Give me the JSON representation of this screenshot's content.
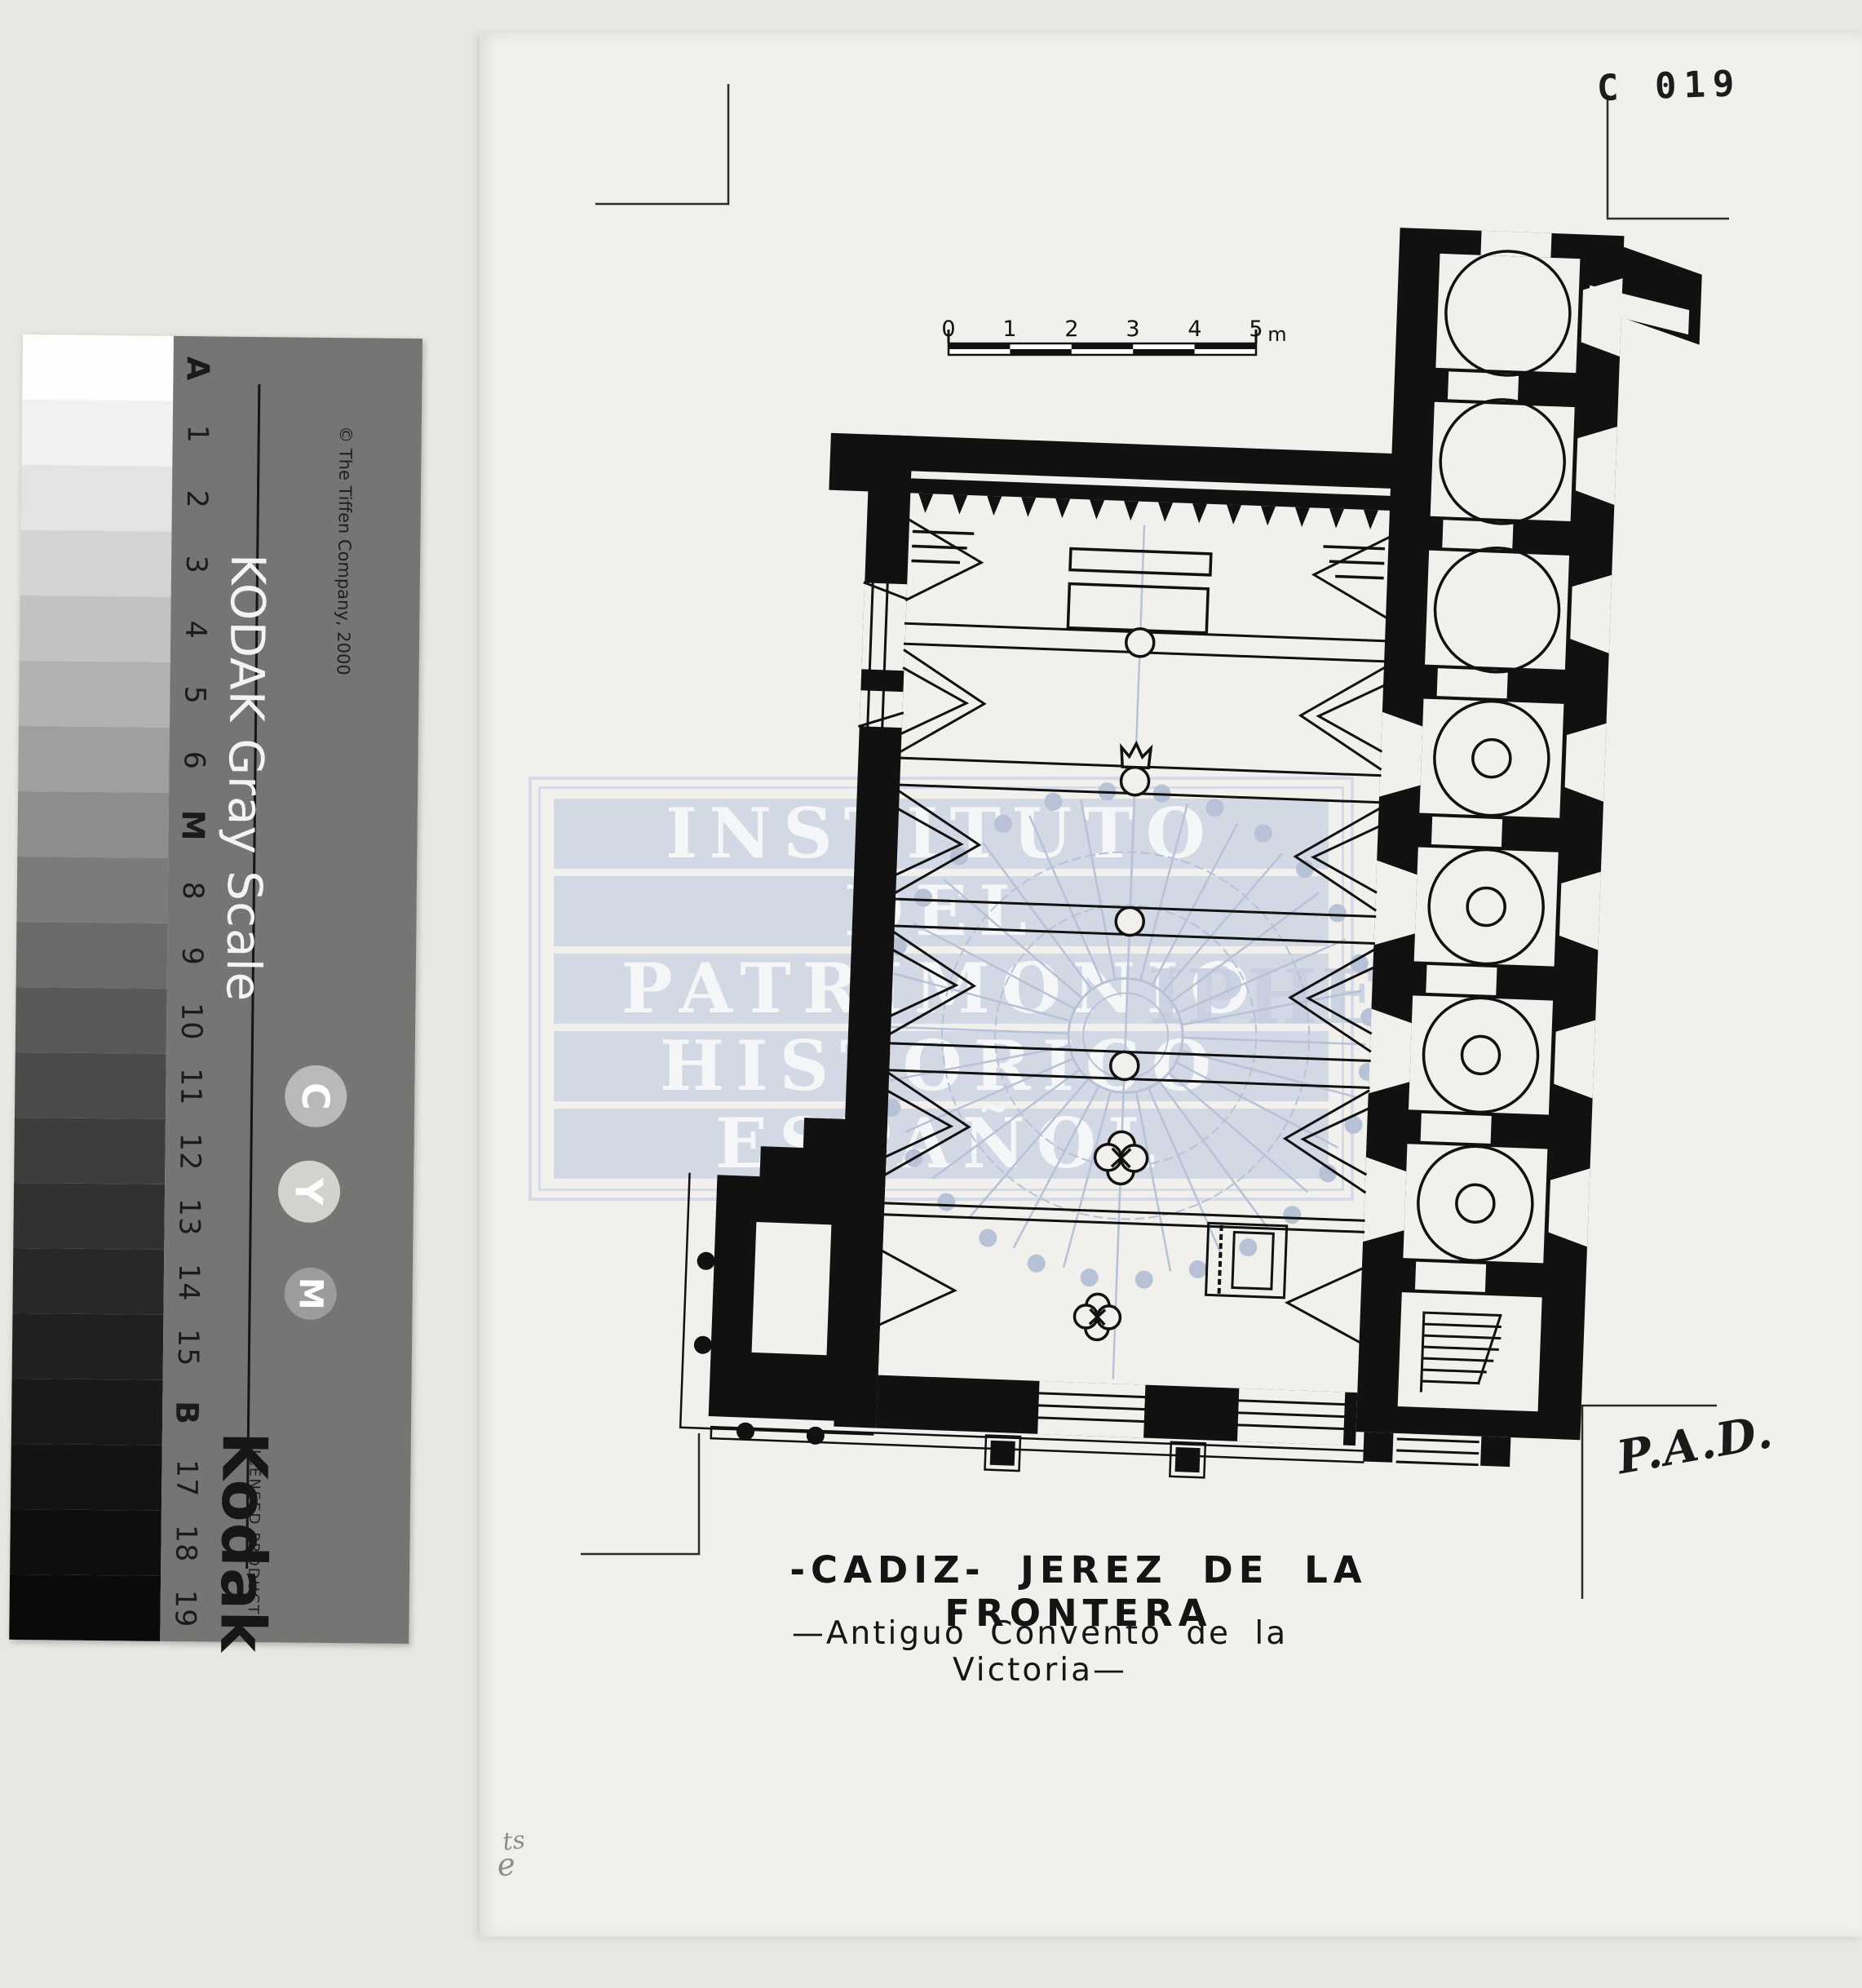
{
  "page": {
    "background_color": "#e8e7e4",
    "paper_color": "#f1f0ed",
    "ink_color": "#101010",
    "stamp_number": "C 019",
    "pencil_note_top": "ts",
    "pencil_note_bottom": "e"
  },
  "kodak_strip": {
    "card_color": "#767574",
    "title": "KODAK Gray Scale",
    "copyright": "© The Tiffen Company, 2000",
    "brand": "Kodak",
    "brand_subtitle": "LICENSED PRODUCT",
    "labels": [
      "A",
      "1",
      "2",
      "3",
      "4",
      "5",
      "6",
      "M",
      "8",
      "9",
      "10",
      "11",
      "12",
      "13",
      "14",
      "15",
      "B",
      "17",
      "18",
      "19"
    ],
    "bold_labels": [
      "A",
      "M",
      "B"
    ],
    "patch_shades": [
      "#fdfdfd",
      "#f1f1f0",
      "#e3e3e2",
      "#d3d3d2",
      "#c2c2c1",
      "#b1b1b0",
      "#9f9f9e",
      "#8d8d8c",
      "#7b7b7a",
      "#6a6a69",
      "#595958",
      "#4a4a49",
      "#3d3d3c",
      "#313130",
      "#282827",
      "#202020",
      "#191919",
      "#131313",
      "#0e0e0e",
      "#0a0a0a"
    ],
    "circles": [
      {
        "letter": "C",
        "color": "#b9b9b8"
      },
      {
        "letter": "Y",
        "color": "#d2d2cf"
      },
      {
        "letter": "M",
        "color": "#9c9c9b"
      }
    ]
  },
  "watermark": {
    "lines": [
      "INSTITUTO",
      "DEL",
      "PATRIMONIO",
      "HISTORICO",
      "ESPAÑOL"
    ],
    "acronym": "IPHE",
    "color": "#cbd3e2"
  },
  "scale_bar": {
    "labels": [
      "0",
      "1",
      "2",
      "3",
      "4",
      "5"
    ],
    "unit": "m"
  },
  "captions": {
    "line1": "-CADIZ-  JEREZ DE LA FRONTERA",
    "line2": "—Antiguo Convento de la Victoria—"
  },
  "signature": "P.A.D.",
  "drawing_colors": {
    "ink": "#111111",
    "dome_blue": "#b7c2d6"
  }
}
